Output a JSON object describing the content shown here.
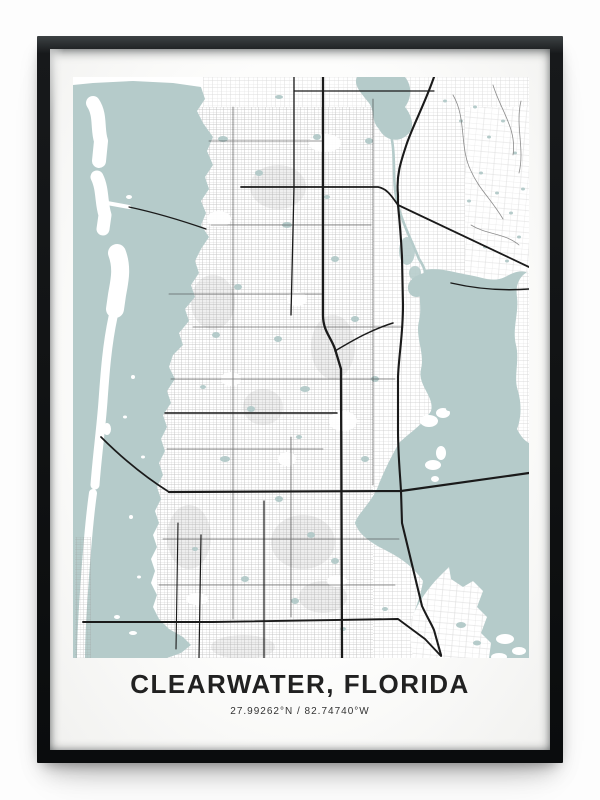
{
  "poster": {
    "title": "CLEARWATER, FLORIDA",
    "coordinates": "27.99262°N / 82.74740°W"
  },
  "colors": {
    "wall": "#fdfdfd",
    "frame": "#101213",
    "matte": "#fdfdfc",
    "water": "#b5cbca",
    "land": "#ffffff",
    "fine_streets": "#9a9a9a",
    "major_roads": "#1a1a1a",
    "title_text": "#212121",
    "coords_text": "#333333"
  },
  "map": {
    "viewbox": "0 0 456 581",
    "features": [
      {
        "name": "land-base",
        "type": "path",
        "d": "M0,0H456V581H0Z",
        "fill": "#ffffff"
      },
      {
        "name": "street-texture-top",
        "type": "path",
        "d": "M130,0H456V30H130Z",
        "fill": "url(#p-med)",
        "opacity": 0.4
      },
      {
        "name": "street-texture-west",
        "type": "path",
        "d": "M84,30H300V581H84Z",
        "fill": "url(#p-dense)",
        "opacity": 0.6
      },
      {
        "name": "street-texture-central",
        "type": "path",
        "d": "M300,30H392V581H300Z",
        "fill": "url(#p-med)",
        "opacity": 0.5
      },
      {
        "name": "street-texture-east",
        "type": "path",
        "d": "M392,30H456V581H392Z",
        "fill": "url(#p-sparse)",
        "opacity": 0.36
      },
      {
        "name": "district-density-blocks",
        "type": "ellipses",
        "fill": "#8e8e8e",
        "opacity": 0.14,
        "items": [
          [
            116,
            460,
            22,
            32
          ],
          [
            170,
            570,
            32,
            12
          ],
          [
            205,
            110,
            28,
            22
          ],
          [
            230,
            465,
            32,
            27
          ],
          [
            260,
            270,
            22,
            32
          ],
          [
            140,
            225,
            22,
            27
          ],
          [
            190,
            330,
            20,
            18
          ],
          [
            250,
            520,
            24,
            16
          ]
        ]
      },
      {
        "name": "park-patches",
        "type": "ellipses",
        "fill": "#ffffff",
        "opacity": 0.92,
        "items": [
          [
            252,
            66,
            16,
            9
          ],
          [
            146,
            142,
            12,
            8
          ],
          [
            270,
            344,
            14,
            10
          ],
          [
            158,
            302,
            10,
            7
          ],
          [
            224,
            222,
            10,
            7
          ],
          [
            124,
            522,
            11,
            6
          ],
          [
            264,
            504,
            10,
            6
          ],
          [
            214,
            382,
            9,
            7
          ]
        ]
      },
      {
        "name": "gulf-and-intracoastal-water",
        "type": "path",
        "d": "M0,8L20,6L60,4L100,6L128,10L132,22L124,34L130,46L140,60L134,74L140,88L132,100L136,112L128,124L133,136L128,148L136,160L128,172L122,184L126,196L118,208L122,220L112,232L116,244L106,256L110,268L100,278L96,290L102,302L94,314L98,326L90,338L94,350L88,362L92,374L86,386L90,398L84,410L88,422L82,434L86,446L80,458L84,470L78,482L82,494L78,506L84,518L80,530L86,542L96,552L110,560L118,568L108,576L94,581L0,581Z",
        "fill": "#b5cbca"
      },
      {
        "name": "lake-tarpon",
        "type": "path",
        "d": "M284,0L332,0C340,10 338,22 332,30C340,40 342,52 334,58C326,66 312,64 306,52C298,44 302,34 296,26C288,16 280,8 284,0Z",
        "fill": "#b5cbca"
      },
      {
        "name": "tarpon-outfall-canal",
        "type": "path",
        "d": "M318,58C323,80 319,104 324,124C329,146 338,162 346,182C350,188 352,192 352,196",
        "stroke": "#b5cbca",
        "width": 2.6
      },
      {
        "name": "wetland-creek",
        "type": "ellipses",
        "fill": "#b5cbca",
        "opacity": 0.88,
        "items": [
          [
            334,
            174,
            8,
            14
          ],
          [
            342,
            196,
            6,
            7
          ]
        ]
      },
      {
        "name": "old-tampa-bay",
        "type": "path",
        "d": "M352,193C342,210 350,228 346,244C342,260 352,276 348,292C344,308 362,320 358,334C350,348 336,356 326,366C318,380 310,396 304,412C296,428 284,438 282,446C286,458 298,466 314,474C330,482 342,492 350,504C348,518 342,532 338,546C342,560 352,570 366,578L376,581L456,581L456,196C446,192 440,196 432,200C420,206 408,200 396,198C382,196 366,190 352,193Z",
        "fill": "#b5cbca"
      },
      {
        "name": "safety-harbor-arm",
        "type": "path",
        "d": "M352,196C342,198 334,204 335,212C336,220 344,222 350,218C356,214 357,204 352,196Z",
        "fill": "#b5cbca"
      },
      {
        "name": "bay-east-shore-land",
        "type": "path",
        "d": "M456,194C448,198 442,206 444,220C446,236 439,252 443,268C447,284 440,300 445,314C449,328 448,342 444,352C448,360 452,364 456,366Z",
        "fill": "#ffffff"
      },
      {
        "name": "bay-east-shore-texture",
        "type": "path",
        "d": "M456,194C448,198 442,206 444,220C446,236 439,252 443,268C447,284 440,300 445,314C449,328 448,342 444,352C448,360 452,364 456,366Z",
        "fill": "url(#p-med)",
        "opacity": 0.42
      },
      {
        "name": "coopers-point-cape",
        "type": "ellipses",
        "fill": "#ffffff",
        "items": [
          [
            360,
            388,
            8,
            5
          ],
          [
            368,
            376,
            5,
            7
          ],
          [
            362,
            402,
            4,
            3
          ],
          [
            356,
            344,
            9,
            6
          ],
          [
            370,
            336,
            7,
            5
          ]
        ]
      },
      {
        "name": "feather-sound-peninsula",
        "type": "path",
        "d": "M340,581C338,566 334,552 340,538C346,524 356,510 366,500C370,496 374,492 376,490L378,502L390,510L400,504L410,514L404,530L414,540L408,556L418,566L416,581Z",
        "fill": "#ffffff"
      },
      {
        "name": "feather-sound-texture",
        "type": "path",
        "d": "M340,581C338,566 334,552 340,538C346,524 356,510 366,500L376,490L378,502L390,510L400,504L410,514L404,530L414,540L408,556L418,566L416,581Z",
        "fill": "url(#p-sparse)",
        "opacity": 0.4
      },
      {
        "name": "bay-islets",
        "type": "ellipses",
        "fill": "#ffffff",
        "items": [
          [
            432,
            562,
            9,
            5
          ],
          [
            446,
            574,
            7,
            4
          ],
          [
            426,
            580,
            8,
            4
          ]
        ]
      },
      {
        "name": "peninsula-lagoons",
        "type": "ellipses",
        "fill": "#b5cbca",
        "items": [
          [
            388,
            548,
            5,
            3
          ],
          [
            404,
            566,
            4,
            2.5
          ],
          [
            430,
            546,
            4,
            2.5
          ]
        ]
      },
      {
        "name": "honeymoon-island",
        "type": "path",
        "d": "M20,26C28,38 24,52 28,64L26,84",
        "stroke": "#ffffff",
        "width": 14
      },
      {
        "name": "caladesi-island",
        "type": "path",
        "d": "M24,100C30,112 28,126 32,138L30,152",
        "stroke": "#ffffff",
        "width": 13
      },
      {
        "name": "island-marina-spit",
        "type": "path",
        "d": "M34,126L56,130",
        "stroke": "#ffffff",
        "width": 4
      },
      {
        "name": "clearwater-beach-island",
        "type": "path",
        "d": "M44,176C50,192 46,206 44,218L42,232",
        "stroke": "#ffffff",
        "width": 18
      },
      {
        "name": "sand-key-island",
        "type": "path",
        "d": "M40,240C34,268 32,296 30,324C28,352 24,380 22,408",
        "stroke": "#ffffff",
        "width": 9
      },
      {
        "name": "indian-rocks-island",
        "type": "path",
        "d": "M20,416C16,444 14,472 12,500C10,528 8,554 8,581",
        "stroke": "#ffffff",
        "width": 8
      },
      {
        "name": "sound-islets",
        "type": "ellipses",
        "fill": "#ffffff",
        "items": [
          [
            56,
            120,
            3,
            2
          ],
          [
            60,
            300,
            2,
            2
          ],
          [
            52,
            340,
            2,
            1.5
          ],
          [
            70,
            380,
            2,
            1.5
          ],
          [
            58,
            440,
            2,
            2
          ],
          [
            66,
            500,
            2,
            1.5
          ],
          [
            44,
            540,
            3,
            2
          ],
          [
            60,
            556,
            4,
            2
          ],
          [
            34,
            352,
            4,
            6
          ]
        ]
      },
      {
        "name": "island-street-texture",
        "type": "path",
        "d": "M2,460H18V581H2Z",
        "fill": "url(#p-dense)",
        "opacity": 0.5
      },
      {
        "name": "mainland-ponds",
        "type": "ellipses",
        "fill": "#b5cbca",
        "items": [
          [
            150,
            62,
            5,
            3
          ],
          [
            186,
            96,
            4,
            3
          ],
          [
            214,
            148,
            5,
            3
          ],
          [
            165,
            210,
            4,
            3
          ],
          [
            143,
            258,
            4,
            3
          ],
          [
            205,
            262,
            4,
            3
          ],
          [
            232,
            312,
            5,
            3
          ],
          [
            178,
            332,
            4,
            3
          ],
          [
            152,
            382,
            5,
            3
          ],
          [
            206,
            422,
            4,
            3
          ],
          [
            238,
            458,
            4,
            3
          ],
          [
            122,
            472,
            3,
            2
          ],
          [
            172,
            502,
            4,
            3
          ],
          [
            222,
            524,
            4,
            3
          ],
          [
            262,
            484,
            4,
            3
          ],
          [
            292,
            382,
            4,
            3
          ],
          [
            302,
            302,
            4,
            3
          ],
          [
            282,
            242,
            4,
            3
          ],
          [
            262,
            182,
            4,
            3
          ],
          [
            296,
            64,
            4,
            3
          ],
          [
            384,
            244,
            4,
            3
          ],
          [
            404,
            300,
            3,
            2
          ],
          [
            376,
            332,
            3,
            2
          ],
          [
            270,
            552,
            3,
            2
          ],
          [
            312,
            532,
            3,
            2
          ],
          [
            244,
            60,
            4,
            3
          ],
          [
            206,
            20,
            4,
            2
          ],
          [
            254,
            120,
            3,
            2
          ],
          [
            226,
            360,
            3,
            2
          ],
          [
            130,
            310,
            3,
            2
          ]
        ]
      },
      {
        "name": "east-lake-ponds",
        "type": "ellipses",
        "fill": "#b5cbca",
        "items": [
          [
            372,
            24,
            2,
            1.5
          ],
          [
            388,
            44,
            2,
            1.5
          ],
          [
            402,
            30,
            2,
            1.5
          ],
          [
            416,
            60,
            2,
            1.5
          ],
          [
            430,
            44,
            2,
            1.5
          ],
          [
            442,
            76,
            2,
            1.5
          ],
          [
            408,
            96,
            2,
            1.5
          ],
          [
            424,
            116,
            2,
            1.5
          ],
          [
            438,
            136,
            2,
            1.5
          ],
          [
            450,
            112,
            2,
            1.5
          ],
          [
            396,
            124,
            2,
            1.5
          ],
          [
            446,
            160,
            2,
            1.5
          ],
          [
            434,
            184,
            2,
            1.5
          ],
          [
            412,
            170,
            2,
            1.5
          ]
        ]
      },
      {
        "name": "east-lake-curvy-roads",
        "type": "path",
        "d": "M380,18C394,42 386,70 398,94C406,112 418,122 430,142M420,8C428,34 444,52 440,78M398,148C414,158 432,156 446,168M448,24C442,48 452,72 446,96",
        "stroke": "#787878",
        "width": 0.8,
        "opacity": 0.85
      },
      {
        "name": "collector-roads",
        "type": "path",
        "d": "M160,30V542M136,64H250M138,148H298M120,250H330M98,302H322M94,372H250M90,462H326M86,508H322M300,22V408M218,360V540M96,217H250",
        "stroke": "#3f3f3f",
        "width": 0.85,
        "opacity": 0.72
      },
      {
        "name": "road-keene",
        "type": "path",
        "d": "M221,0L221,110L218,238",
        "stroke": "#1a1a1a",
        "width": 1.3
      },
      {
        "name": "road-top-east-west",
        "type": "path",
        "d": "M221,14L361,14",
        "stroke": "#1a1a1a",
        "width": 1.2
      },
      {
        "name": "road-sr580",
        "type": "path",
        "d": "M168,110L305,110C315,112 319,120 325,128L456,190",
        "stroke": "#1a1a1a",
        "width": 1.8
      },
      {
        "name": "road-sr590-east",
        "type": "path",
        "d": "M378,206C404,212 430,214 456,212",
        "stroke": "#1a1a1a",
        "width": 1.4
      },
      {
        "name": "road-drew-diagonal",
        "type": "path",
        "d": "M262,274C282,262 300,252 320,246",
        "stroke": "#1a1a1a",
        "width": 1.5
      },
      {
        "name": "road-belleair",
        "type": "path",
        "d": "M92,336L264,336",
        "stroke": "#1a1a1a",
        "width": 1.5
      },
      {
        "name": "road-honeymoon-causeway",
        "type": "path",
        "d": "M56,130C84,136 110,144 133,152",
        "stroke": "#1a1a1a",
        "width": 1.2
      },
      {
        "name": "road-memorial-causeway",
        "type": "path",
        "d": "M28,360C48,380 72,400 96,415",
        "stroke": "#1a1a1a",
        "width": 1.7
      },
      {
        "name": "road-sr60-gulf-to-bay",
        "type": "path",
        "d": "M96,415L328,414L456,396",
        "stroke": "#1a1a1a",
        "width": 2.2
      },
      {
        "name": "road-ulmerton",
        "type": "path",
        "d": "M10,545L140,545L325,542L352,562L368,579",
        "stroke": "#1a1a1a",
        "width": 1.9
      },
      {
        "name": "road-us19",
        "type": "path",
        "d": "M250,0L250,238C250,254 258,260 262,272L268,292L269,581",
        "stroke": "#1a1a1a",
        "width": 2.3
      },
      {
        "name": "road-mcmullen-bayside",
        "type": "path",
        "d": "M361,0C352,26 342,44 334,66C328,84 323,98 325,118L325,128C327,148 328,160 329,180L330,228C330,258 326,276 325,300L325,352C325,378 327,396 328,414L329,446L349,529C354,540 358,546 361,553L368,578",
        "stroke": "#1a1a1a",
        "width": 2.1
      },
      {
        "name": "road-bottom-vertical-1",
        "type": "path",
        "d": "M191,424L191,581",
        "stroke": "#1a1a1a",
        "width": 1.2
      },
      {
        "name": "road-bottom-vertical-2",
        "type": "path",
        "d": "M128,458L126,581",
        "stroke": "#1a1a1a",
        "width": 1.2
      },
      {
        "name": "road-bottom-vertical-3",
        "type": "path",
        "d": "M105,446L103,572",
        "stroke": "#1a1a1a",
        "width": 1.1
      }
    ]
  }
}
